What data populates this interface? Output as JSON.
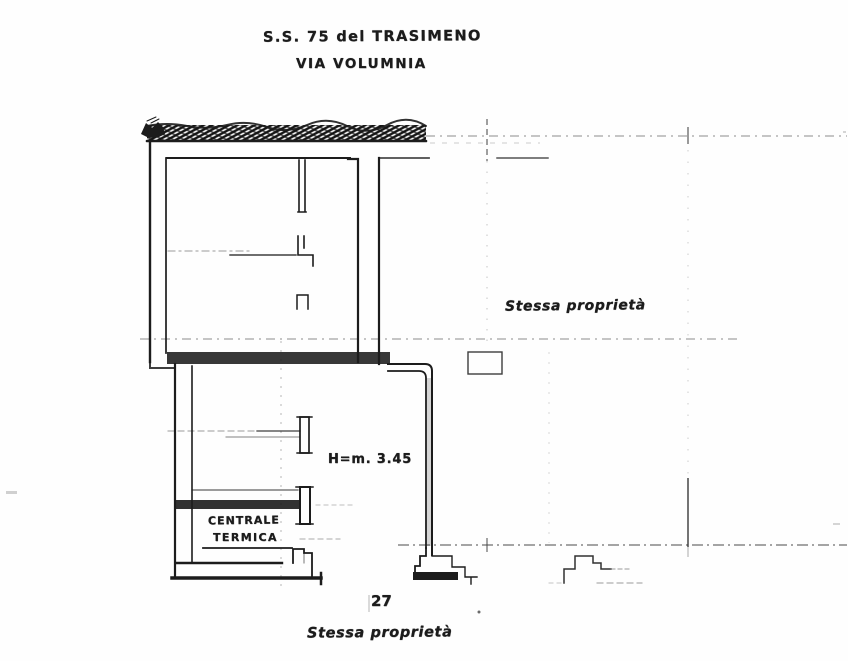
{
  "labels": {
    "title_line1": "S.S. 75 del TRASIMENO",
    "title_line2": "VIA VOLUMNIA",
    "right_area_note": "Stessa proprietà",
    "height_note": "H=m. 3.45",
    "room_name_line1": "CENTRALE",
    "room_name_line2": "TERMICA",
    "page_number": "27",
    "bottom_area_note": "Stessa proprietà"
  },
  "colors": {
    "ink": "#1c1c1c",
    "faded": "#6f6f6f",
    "paper": "#fefefe"
  }
}
